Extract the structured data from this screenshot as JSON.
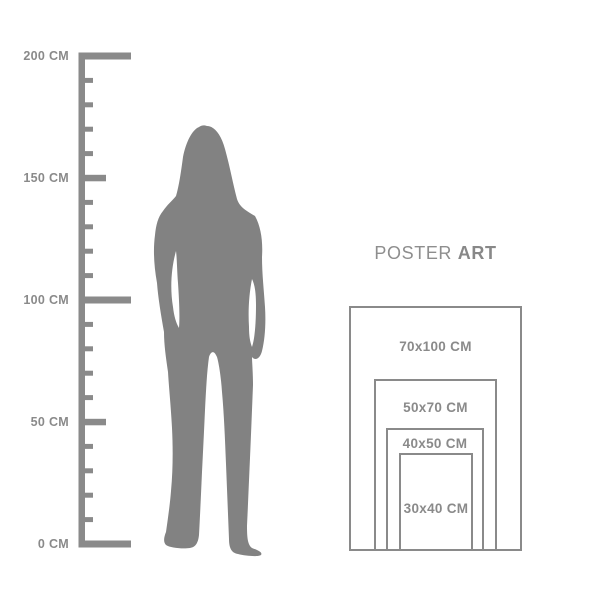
{
  "ruler": {
    "unit": "CM",
    "marks": [
      {
        "value": 200,
        "label": "200 CM"
      },
      {
        "value": 150,
        "label": "150 CM"
      },
      {
        "value": 100,
        "label": "100 CM"
      },
      {
        "value": 50,
        "label": "50 CM"
      },
      {
        "value": 0,
        "label": "0 CM"
      }
    ]
  },
  "figure": {
    "icon": "woman-silhouette"
  },
  "brand": {
    "regular": "POSTER",
    "bold": "ART"
  },
  "poster_sizes": [
    {
      "label": "70x100 CM"
    },
    {
      "label": "50x70 CM"
    },
    {
      "label": "40x50 CM"
    },
    {
      "label": "30x40 CM"
    }
  ],
  "colors": {
    "ruler_gray": "#8a8a8a",
    "silhouette_gray": "#828282",
    "background": "#ffffff"
  }
}
